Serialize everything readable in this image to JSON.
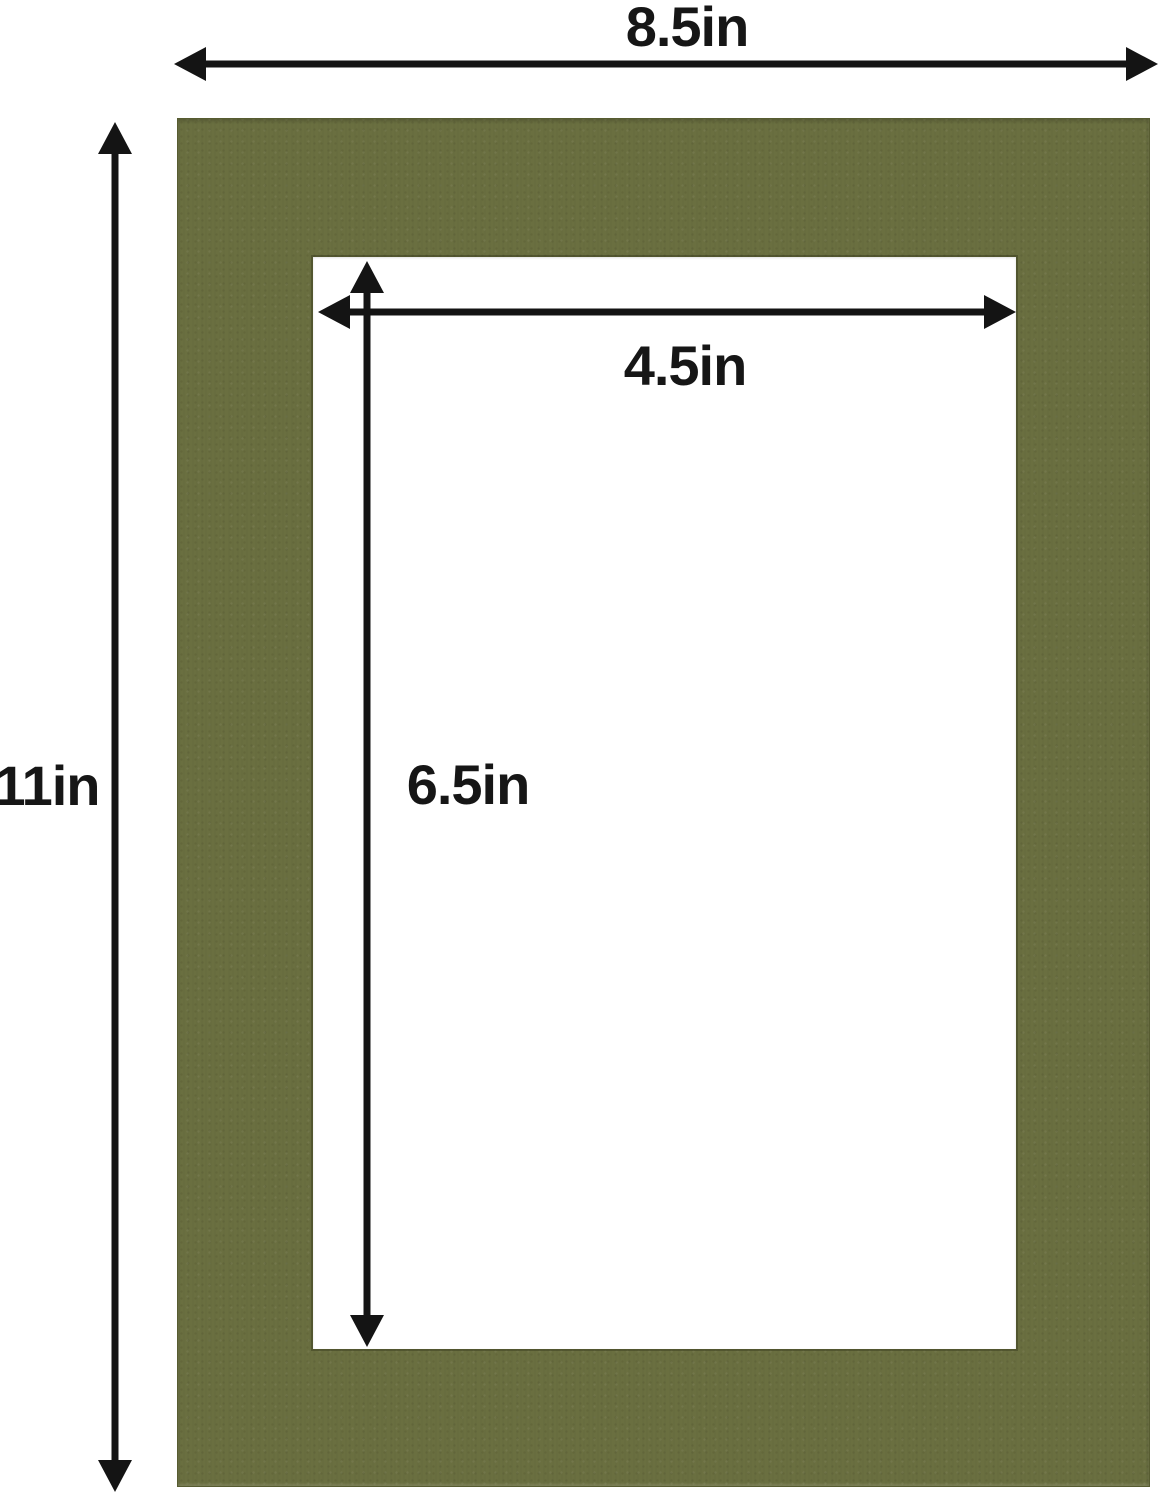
{
  "diagram": {
    "kind": "picture-mat-dimension-diagram",
    "labels": {
      "outer_width": "8.5in",
      "outer_height": "11in",
      "opening_width": "4.5in",
      "opening_height": "6.5in"
    }
  },
  "colors": {
    "background": "#ffffff",
    "mat": "#6a6f40",
    "mat-edge": "#575c31",
    "opening": "#ffffff",
    "arrow": "#141414",
    "label": "#161616"
  }
}
